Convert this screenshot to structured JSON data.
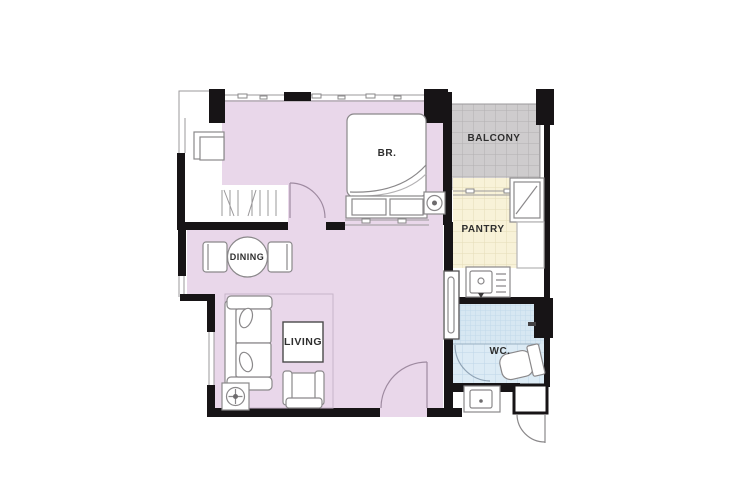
{
  "plan": {
    "rooms": {
      "bedroom": {
        "label": "BR."
      },
      "balcony": {
        "label": "BALCONY"
      },
      "pantry": {
        "label": "PANTRY"
      },
      "dining": {
        "label": "DINING"
      },
      "living": {
        "label": "LIVING"
      },
      "wc": {
        "label": "WC."
      }
    },
    "colors": {
      "floor_main": "#e9d7ea",
      "balcony": "#cecccd",
      "pantry": "#f8f2d8",
      "wc": "#dcebf5",
      "shower": "#d7e7f2",
      "wall": "#171416",
      "label_text": "#2e2e2e"
    }
  }
}
